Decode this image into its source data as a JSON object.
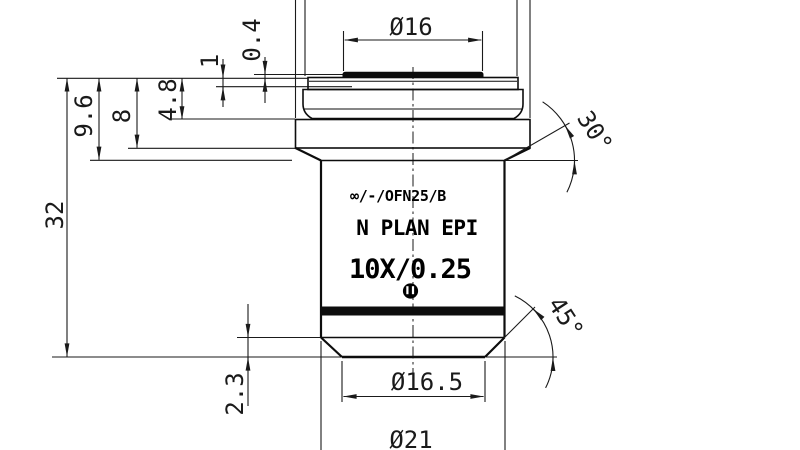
{
  "drawing": {
    "kind": "objective-lens-dimension-drawing",
    "colors": {
      "ink": "#1a1a1a",
      "background": "#ffffff",
      "engraving": "#000000",
      "ring_band": "#0d0d0d"
    },
    "dims": {
      "d16": "Ø16",
      "d0_4": "0.4",
      "d1": "1",
      "d4_8": "4.8",
      "d8": "8",
      "d9_6": "9.6",
      "d32": "32",
      "d2_3": "2.3",
      "d16_5": "Ø16.5",
      "d21": "Ø21"
    },
    "angles": {
      "a30": "30°",
      "a45": "45°"
    },
    "engraving": {
      "line1": "∞/-/OFN25/B",
      "line2": "N PLAN EPI",
      "line3": "10X/0.25"
    }
  }
}
